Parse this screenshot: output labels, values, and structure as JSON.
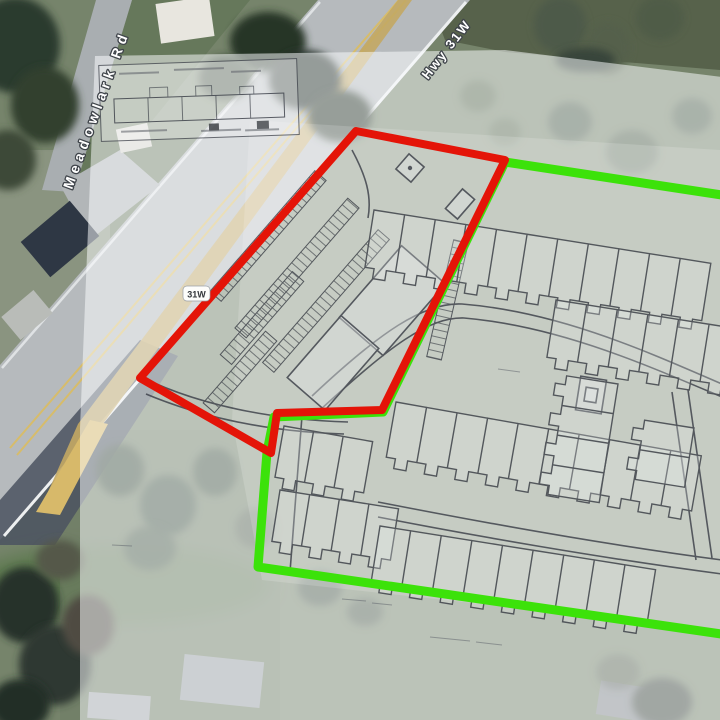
{
  "roads": {
    "primary_label": "Meadowlark Rd",
    "highway_label": "Hwy 31W",
    "route_shield": "31W"
  },
  "boundaries": {
    "commercial_outline_color": "#e41408",
    "residential_outline_color": "#3ce20a"
  }
}
